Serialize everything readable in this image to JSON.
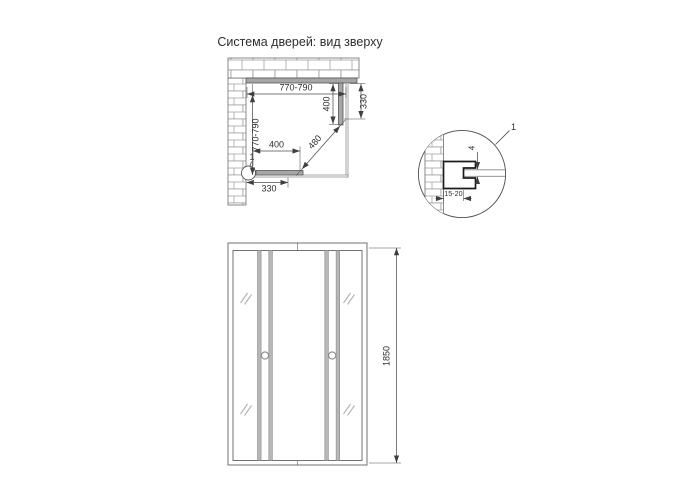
{
  "title": "Система дверей: вид зверху",
  "colors": {
    "line": "#4d4d4d",
    "panel_fill": "#a6a6a6",
    "rail_fill": "#b7b7b7",
    "glass_mark": "#b3b3b3"
  },
  "plan": {
    "dim_width_top": "770-790",
    "dim_depth_left": "770-790",
    "dim_side_panel_right": "400",
    "dim_wall_offset_right": "330",
    "dim_side_panel_bottom": "400",
    "dim_wall_offset_bottom": "330",
    "dim_door_opening_diagonal": "480",
    "detail_callout": "1"
  },
  "detail": {
    "callout": "1",
    "dim_glass_thickness": "4",
    "dim_profile_adjustment": "15-20"
  },
  "elevation": {
    "dim_height": "1850"
  }
}
